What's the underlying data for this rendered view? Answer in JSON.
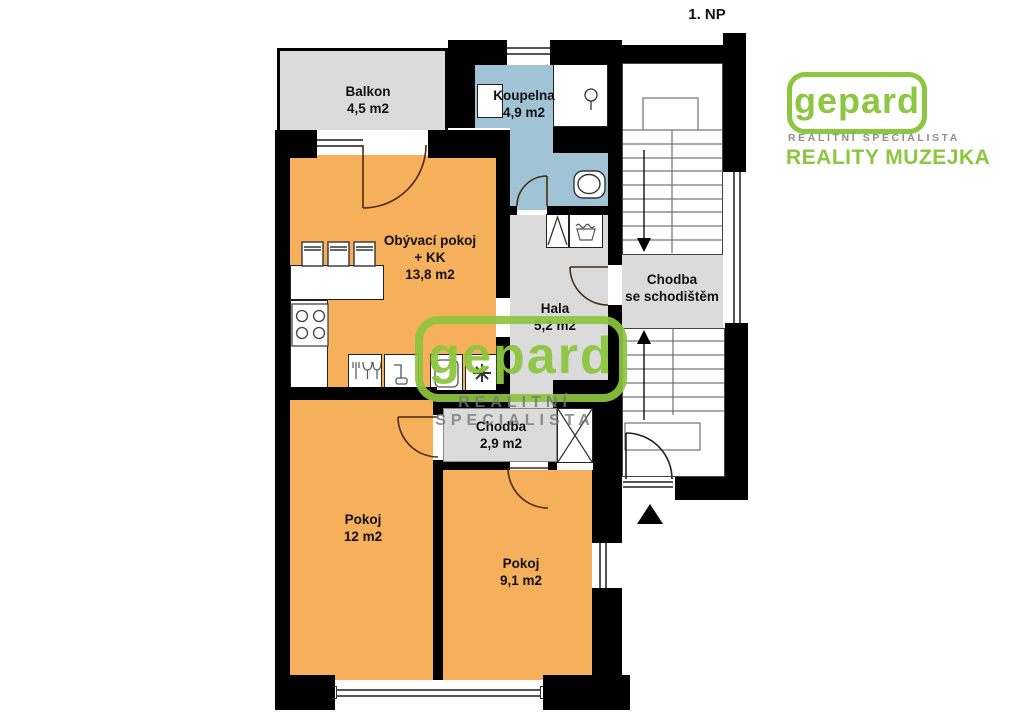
{
  "floor_label": "1. NP",
  "rooms": {
    "balkon": {
      "label": "Balkon",
      "area": "4,5 m2"
    },
    "koupelna": {
      "label": "Koupelna",
      "area": "4,9 m2"
    },
    "obyvaci_pokoj": {
      "label": "Obývací pokoj",
      "line2": "+ KK",
      "area": "13,8 m2"
    },
    "hala": {
      "label": "Hala",
      "area": "5,2 m2"
    },
    "chodba_se_schodistem": {
      "line1": "Chodba",
      "line2": "se schodištěm"
    },
    "chodba": {
      "label": "Chodba",
      "area": "2,9 m2"
    },
    "pokoj_12": {
      "label": "Pokoj",
      "area": "12 m2"
    },
    "pokoj_9_1": {
      "label": "Pokoj",
      "area": "9,1 m2"
    }
  },
  "branding": {
    "logo": "gepard",
    "tagline": "REALITNÍ SPECIALISTA",
    "agency": "REALITY MUZEJKA"
  },
  "watermark": {
    "text": "gepard",
    "tagline": "REALITNÍ SPECIALISTA"
  },
  "icons": {
    "stairs-down-arrow": "filled triangle pointing down",
    "stairs-up-arrow": "filled triangle pointing up",
    "entrance-arrow": "filled triangle pointing up",
    "snowflake-icon": "asterisk snowflake",
    "shower-head-icon": "circle with stem",
    "stove-icon": "four burner circles",
    "sink-icon": "faucet",
    "dishwasher-icon": "fork and glasses",
    "fridge-icon": "rounded rectangle",
    "laundry-basket-icon": "trapezoid with wavy top",
    "wardrobe-icon": "triangle",
    "closet-icon": "crossed diagonals"
  },
  "colors": {
    "room_orange": "#F6B05C",
    "floor_gray": "#DBDBDB",
    "bath_blue": "#A0C4D6",
    "wall_black": "#000000",
    "brand_green": "#8DC63F"
  }
}
